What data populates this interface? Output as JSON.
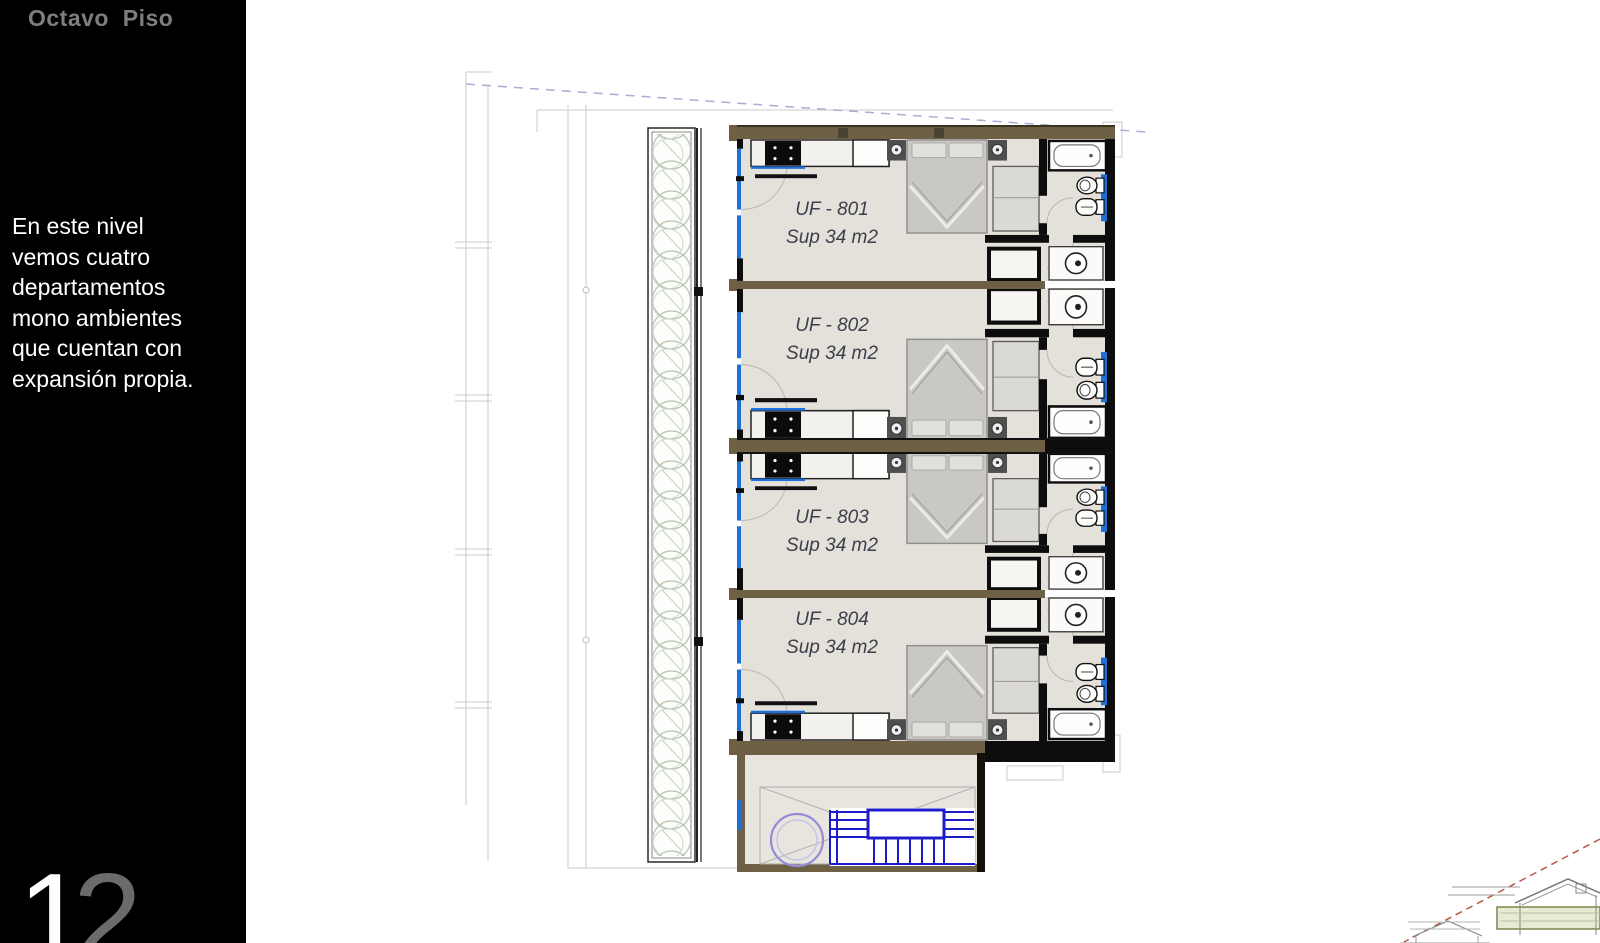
{
  "sidebar": {
    "title": "Octavo  Piso",
    "description": "En este nivel\nvemos cuatro\ndepartamentos\nmono ambientes\nque cuentan con\nexpansión propia.",
    "page_number": "12",
    "page_number_digits": [
      "1",
      "2"
    ]
  },
  "plan": {
    "units": [
      {
        "id": "UF - 801",
        "sup": "Sup 34 m2"
      },
      {
        "id": "UF - 802",
        "sup": "Sup 34 m2"
      },
      {
        "id": "UF - 803",
        "sup": "Sup 34 m2"
      },
      {
        "id": "UF - 804",
        "sup": "Sup 34 m2"
      }
    ]
  },
  "colors": {
    "sidebar_background": "#000000",
    "title_gray": "#7e7e7e",
    "body_text": "#ffffff",
    "wall_olive": "#6d6044",
    "wall_black": "#0d0d0d",
    "window_blue": "#1f6fd9",
    "floor_beige": "#e4e1da",
    "stair_blue": "#1c1ccc",
    "elevator_purple": "#958cd8",
    "label_text": "#3d3e4b",
    "tree_green": "#b9c9b3",
    "sketch_red": "#b65848",
    "sketch_band_green": "#e7ebd2"
  }
}
